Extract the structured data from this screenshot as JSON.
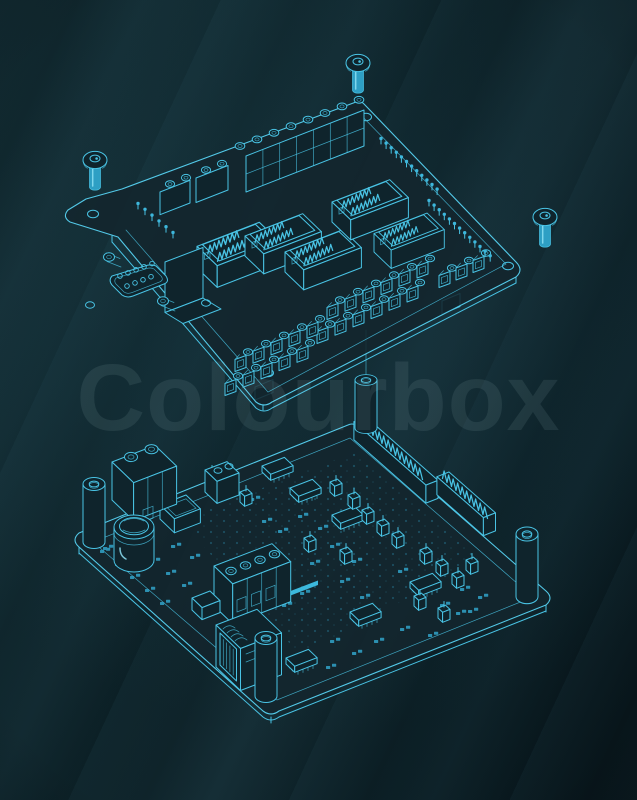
{
  "image": {
    "width": 637,
    "height": 800,
    "kind": "blueprint-style isometric technical illustration",
    "subject": "Exploded view of a terminal shield board with mounting screws above an assembled controller circuit board"
  },
  "watermark": {
    "text": "Colourbox"
  },
  "colors": {
    "background_light": "#122b32",
    "background_base": "#0c2026",
    "background_dark": "#071318",
    "line": "#49c3e4",
    "line_bright": "#8de0f4",
    "fill_accent": "#2e9fc4",
    "fill_bright": "#3cb8dc",
    "board_surface": "#13262e",
    "watermark": "rgba(214,238,243,0.085)"
  },
  "scene": {
    "boards": [
      {
        "id": "top-board",
        "label": "terminal shield board, exploded view",
        "components": [
          "mounting screws x3",
          "screw terminal strip rows",
          "IDC box headers x5",
          "DB9 serial connector with bracket",
          "terminal clamp strips x4",
          "breakout pin rows",
          "mounting holes x4"
        ]
      },
      {
        "id": "bottom-board",
        "label": "controller PCB, assembled",
        "components": [
          "standoff spacers x4",
          "electrolytic capacitor",
          "2-position screw terminal",
          "4-position screw terminal",
          "RJ45 jack",
          "long edge pin connector x2",
          "SOIC chips x6",
          "jumper headers",
          "SMD pads",
          "via speckles",
          "power trace bar"
        ]
      }
    ]
  }
}
